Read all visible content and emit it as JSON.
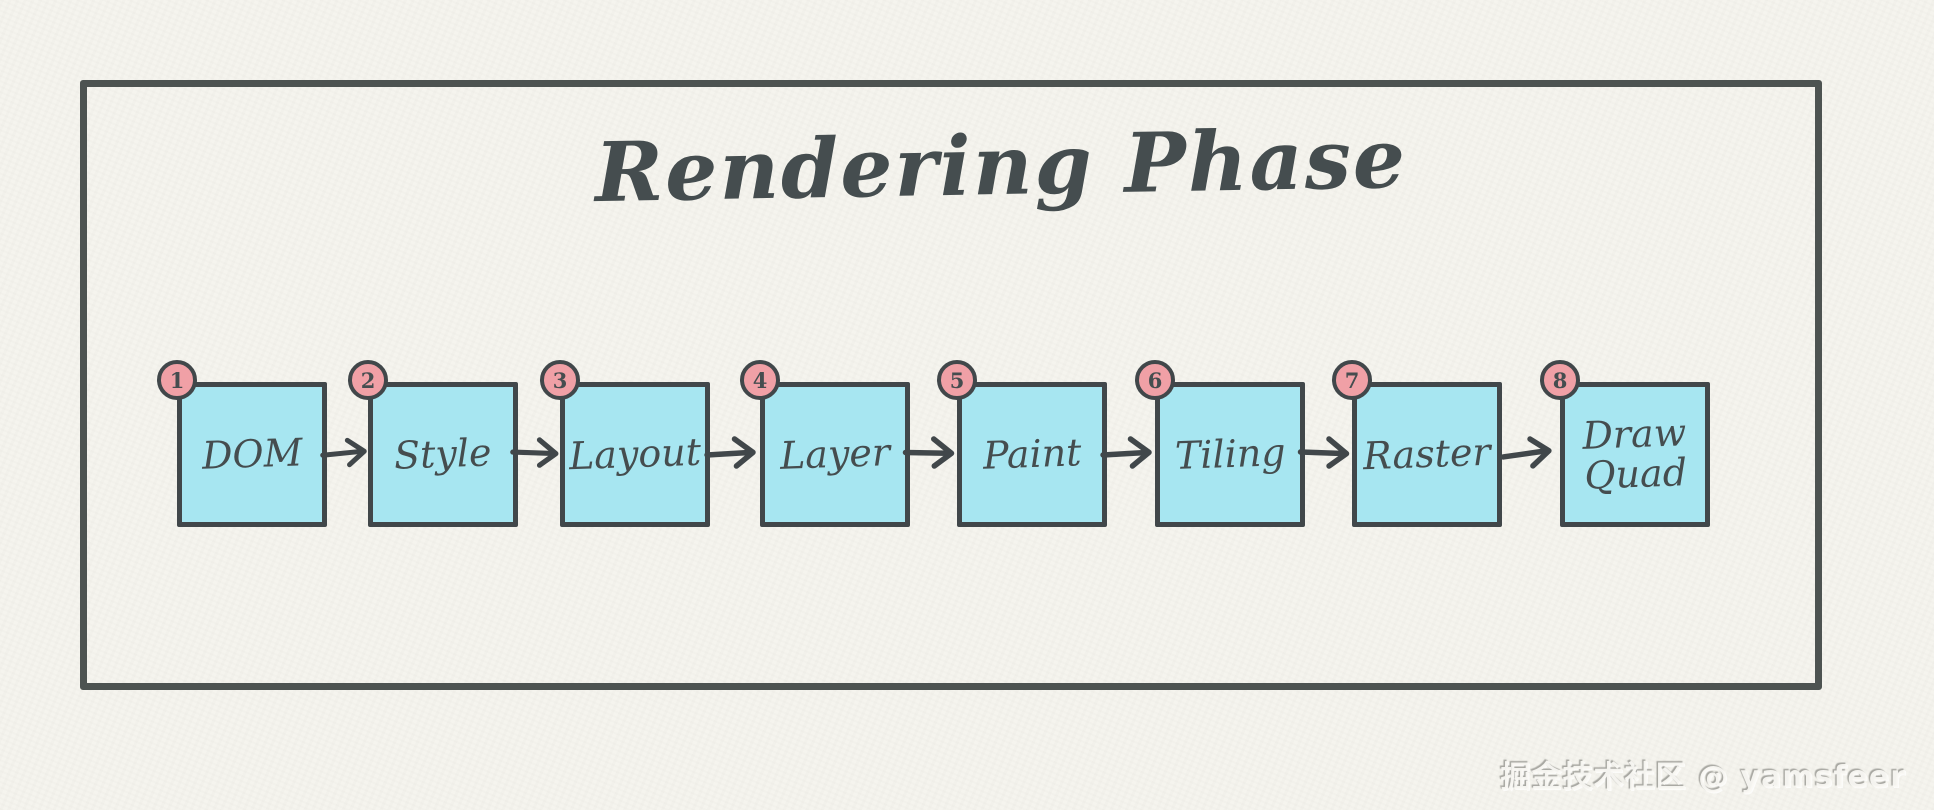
{
  "diagram": {
    "title": "Rendering Phase",
    "steps": [
      {
        "number": "1",
        "label": "DOM"
      },
      {
        "number": "2",
        "label": "Style"
      },
      {
        "number": "3",
        "label": "Layout"
      },
      {
        "number": "4",
        "label": "Layer"
      },
      {
        "number": "5",
        "label": "Paint"
      },
      {
        "number": "6",
        "label": "Tiling"
      },
      {
        "number": "7",
        "label": "Raster"
      },
      {
        "number": "8",
        "label": "Draw Quad"
      }
    ],
    "colors": {
      "paper": "#f5f4ee",
      "frame_border": "#4d5351",
      "box_fill": "#a7e6f1",
      "box_border": "#41474a",
      "badge_fill": "#f0a0a6",
      "badge_border": "#41474a",
      "arrow": "#41474a",
      "text": "#454d4f"
    }
  },
  "watermark": {
    "text": "掘金技术社区 @ yamsfeer"
  }
}
